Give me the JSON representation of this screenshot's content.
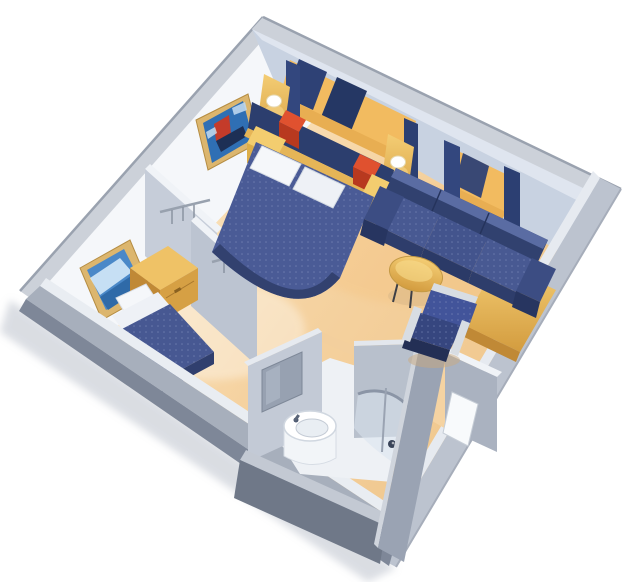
{
  "scene": {
    "kind": "isometric-cutaway-floorplan",
    "subject": "stateroom with double bed, sofa sitting area, closets, twin-bed alcove and bathroom"
  },
  "inventory": [
    "double-bed",
    "pillows",
    "headboard",
    "nightstand",
    "reading-lamp",
    "wall-sconce",
    "window-curtains",
    "sofa",
    "coffee-table",
    "armchair",
    "desk-unit",
    "closet-rail",
    "twin-bed",
    "vanity-cabinet",
    "wall-art-sailboat",
    "wall-art-seascape",
    "bathroom-sink",
    "bathroom-mirror",
    "curved-shower",
    "entry-door"
  ],
  "palette": {
    "background": "#ffffff",
    "shadow": "#b6bcc7",
    "wall_top_strip": "#ccd1d9",
    "wall_edge": "#9aa2af",
    "wall_face_white": "#f5f7fa",
    "wall_face_blue": "#c8d2e1",
    "wall_face_blue_light": "#dfe5ef",
    "right_wall_outer": "#bcc3cf",
    "right_wall_strip": "#e6eaf0",
    "band_inner_edge": "#e9edf2",
    "band_top": "#a7afbc",
    "band_outer": "#7e8798",
    "partition_face": "#c6cdd9",
    "partition_face2": "#bcc4d1",
    "partition_strip": "#f0f3f7",
    "bath_wall_inner": "#c3cad6",
    "bath_wall_right": "#b8c0cc",
    "bath_wall_dark": "#6f7888",
    "bath_wall_mid": "#9aa3b3",
    "bath_floor": "#eef1f5",
    "mirror": "#97a1b1",
    "glass": "#dbe3ee",
    "chrome": "#d8dde3",
    "rail_metal": "#98a1ae",
    "floor_light": "#fdeccd",
    "floor_mid": "#f5d2a0",
    "floor_deep": "#eec488",
    "wood_light": "#f4cd74",
    "wood_dark": "#d39c3f",
    "wood_side": "#c08936",
    "wood_top": "#efc266",
    "wood_front": "#d6a044",
    "nightstand_top": "#f3cd6f",
    "nightstand_front": "#ddae49",
    "ledge_wood": "#e5b557",
    "window_amber": "#f2bb60",
    "window_sill": "#e8ae52",
    "shutter_navy": "#2e4175",
    "curtain_navy": "#33477e",
    "headboard_navy": "#2c3e6e",
    "spread_navy": "#4a5b96",
    "spread_dark": "#32416f",
    "twin_spread": "#475892",
    "sofa_back": "#31416f",
    "sofa_back_hl": "#5a6ca3",
    "sofa_seat": "#485992",
    "sofa_front": "#2e3d6b",
    "chair_back": "#42549a",
    "chair_seat": "#36467f",
    "chair_base": "#232f55",
    "lamp_red": "#e0512f",
    "lamp_red_dark": "#b8391f",
    "pillow_white": "#f5f7fa",
    "sheet_white": "#eef1f6",
    "art_frame": "#dcb66e",
    "art_frame_edge": "#b58d43",
    "art_sky": "#2f6fb4",
    "art_sea": "#4a88c8",
    "art_wave": "#dceefc",
    "art_sail_red": "#c43b2a",
    "art_hull": "#1d2f55",
    "fixture_white": "#ffffff",
    "fixture_shade": "#e9eef3",
    "handle_dark": "#3a4459"
  }
}
